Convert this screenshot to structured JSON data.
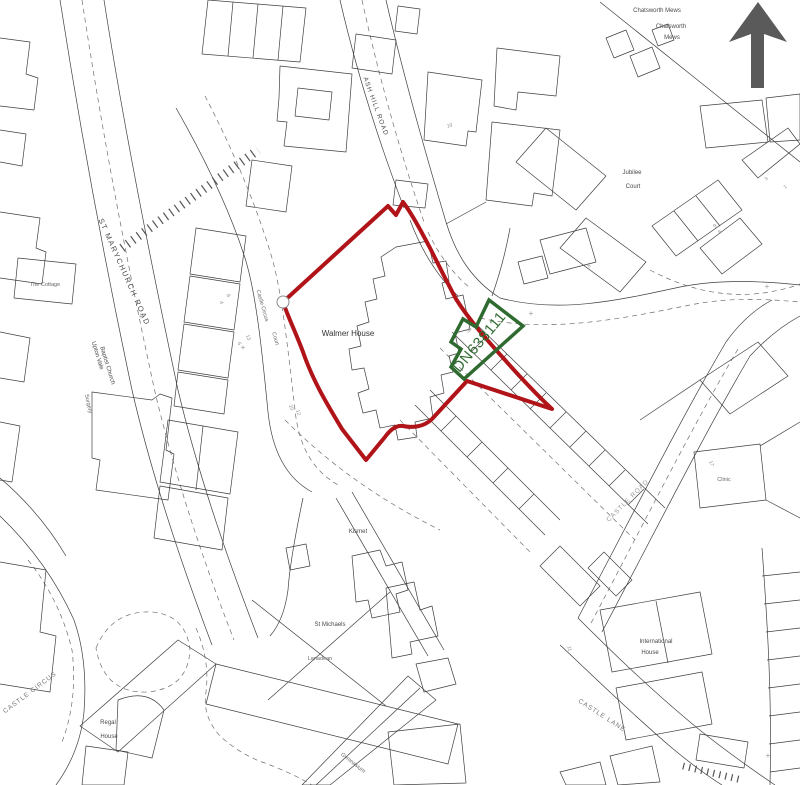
{
  "colors": {
    "site_boundary": "#b01318",
    "title_boundary": "#2f6b31",
    "north_arrow": "#5a5a5a",
    "map_ink": "#3f3f3f"
  },
  "icons": {
    "north_arrow": "up-arrow"
  },
  "boundaries": {
    "title_number": "DN638111",
    "plot_number": "38"
  },
  "labels": {
    "walmer_house": "Walmer House",
    "st_marychurch_road": "ST MARYCHURCH ROAD",
    "ash_hill_road": "ASH HILL ROAD",
    "castle_road": "CASTLE ROAD",
    "castle_lane": "CASTLE LANE",
    "castle_circus": "CASTLE CIRCUS",
    "castle_circus_court_1": "Castle Circus",
    "castle_circus_court_2": "Court",
    "upton_vale_1": "Upton Vale",
    "upton_vale_2": "Baptist Church",
    "the_cottage": "The Cottage",
    "jubilee_1": "Jubilee",
    "jubilee_2": "Court",
    "chatsworth_mews": "Chatsworth Mews",
    "chatsworth_1": "Chatsworth",
    "chatsworth_2": "Mews",
    "regal_1": "Regal",
    "regal_2": "House",
    "kismet": "Kismet",
    "st_michaels": "St Michaels",
    "lanadean": "Lanadean",
    "international_1": "International",
    "international_2": "House",
    "clinic": "Clinic",
    "gymnasium": "Gymnasium",
    "surgery": "Surgery",
    "cross_mark": "+"
  },
  "house_numbers": [
    "8",
    "4",
    "13",
    "6",
    "10",
    "12",
    "19",
    "3",
    "1",
    "9",
    "6",
    "8",
    "11",
    "17"
  ]
}
